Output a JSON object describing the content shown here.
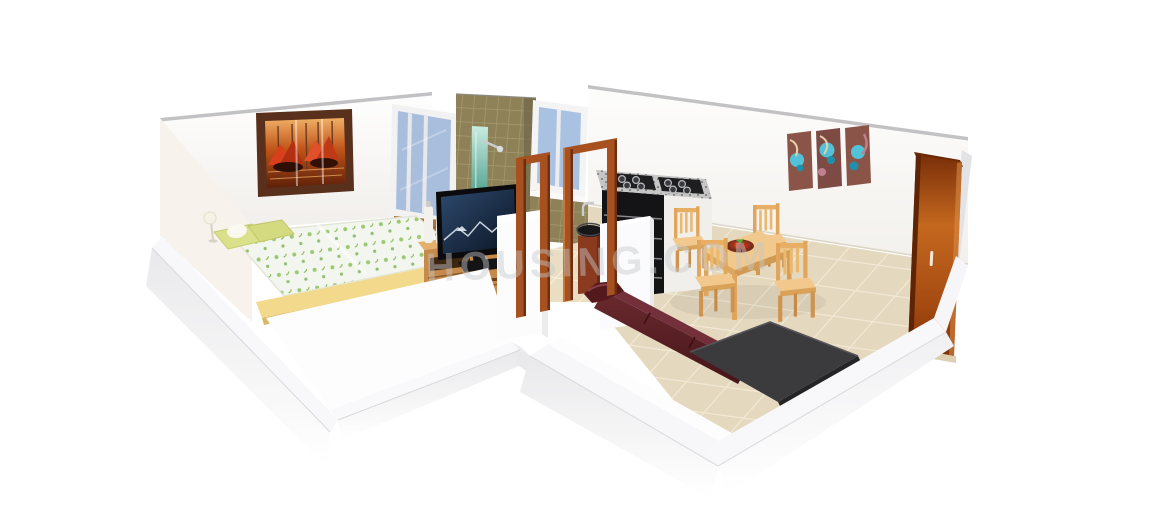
{
  "scene": {
    "description": "3D cutaway render of a one-bedroom apartment floor plan",
    "watermark": "HOUSING.COM"
  },
  "palette": {
    "background": "#ffffff",
    "wall_white": "#fcfbfa",
    "wall_edge_gray": "#c2c2c4",
    "wall_shadow": "#ebebed",
    "floor_tile": "#e9ddc2",
    "tile_grout": "#f6eeda",
    "bathroom_tile": "#8e8157",
    "shower_teal": "#53a893",
    "window_glass": "#a9bedd",
    "door_frame_wood": "#a6511f",
    "wardrobe_wood": "#b05415",
    "dresser_wood": "#c68a4c",
    "dining_wood": "#efb975",
    "footboard_wood": "#f2d98b",
    "sofa_maroon": "#5a1e22",
    "kitchen_black": "#141416",
    "granite_gray": "#c6c6c6",
    "bed_blanket": "#f3f6ee",
    "bed_accent_green": "#85bd53",
    "pillow_yellow": "#dbe18a",
    "tv_screen_blue": "#22385a",
    "rug_dark": "#3b3b3d",
    "painting_orange": "#c65a1e",
    "art_teal": "#52c2d8"
  },
  "objects": {
    "bedroom": [
      "gondola painting",
      "window",
      "double bed",
      "pillows",
      "table lamp",
      "TV dresser",
      "flat-screen TV",
      "cosmetic bottles"
    ],
    "bathroom": [
      "olive tiled wall",
      "shower panel",
      "window"
    ],
    "kitchen": [
      "granite counter with gas stove",
      "black drawer unit",
      "wash basin on wooden stand",
      "faucet"
    ],
    "living_dining": [
      "wooden door frames",
      "dining table",
      "four chairs",
      "fruit plate",
      "maroon sofa",
      "dark rug",
      "triptych wall art",
      "wardrobe"
    ]
  }
}
